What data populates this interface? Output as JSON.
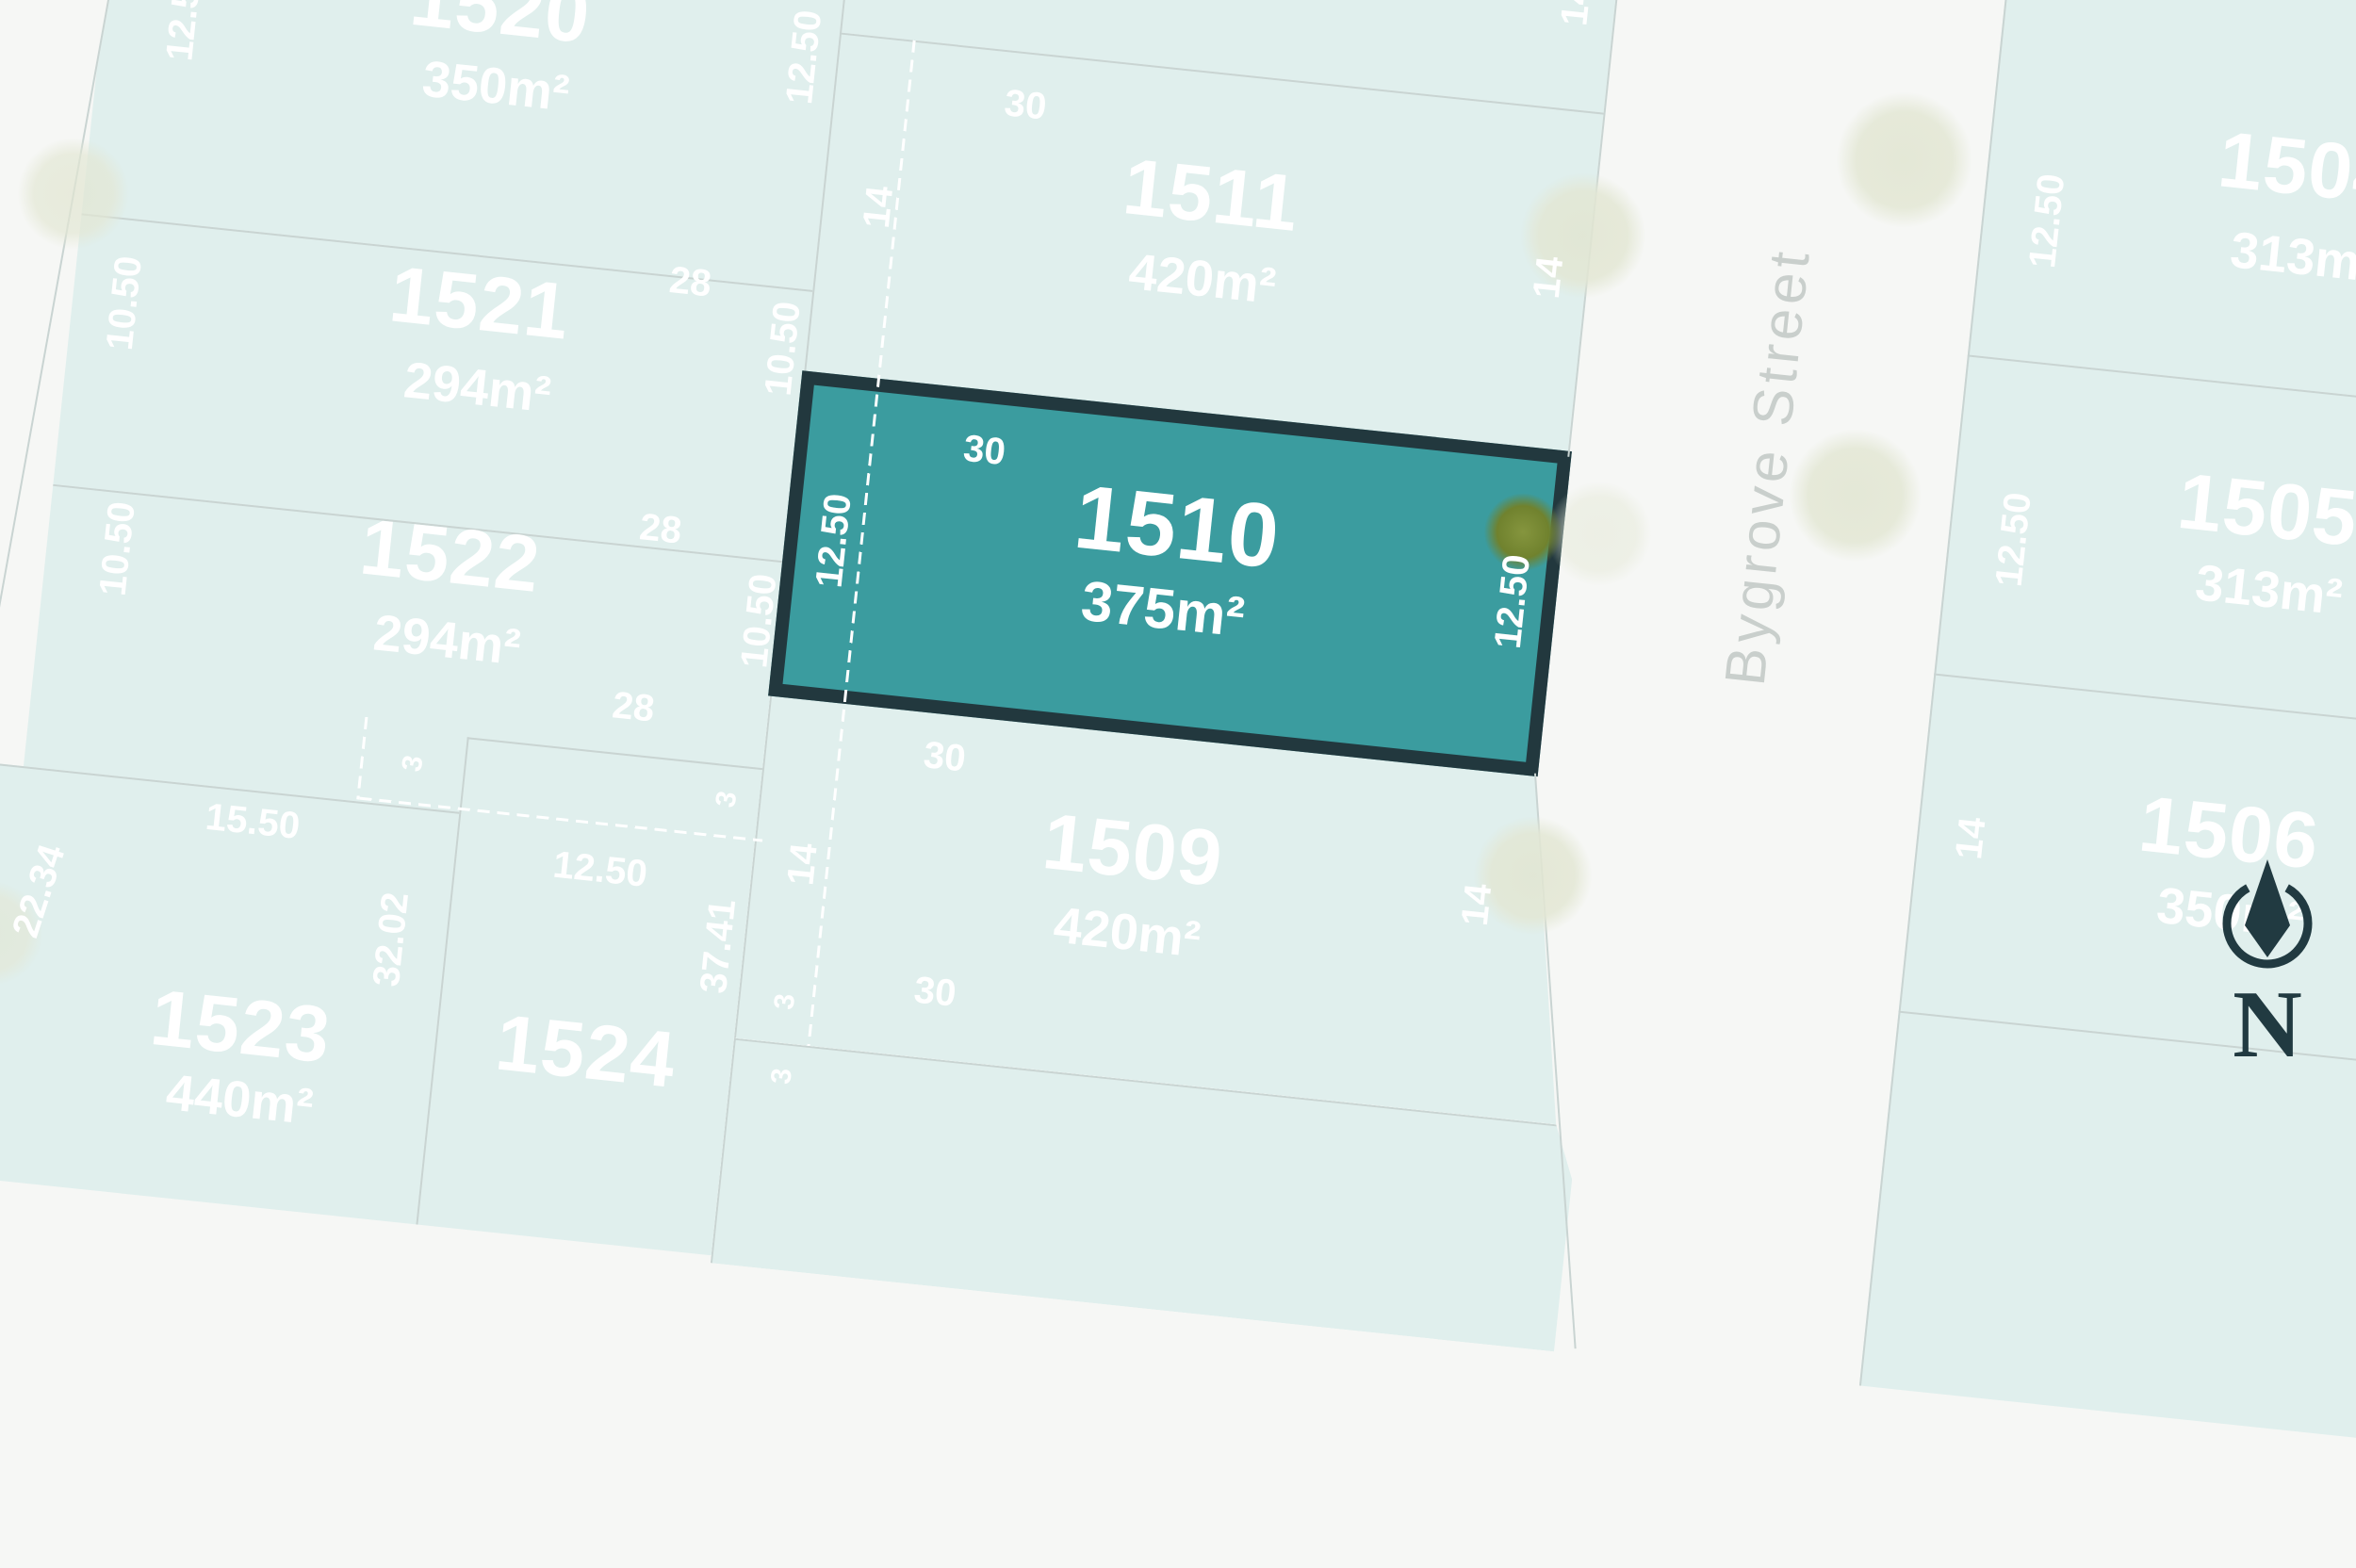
{
  "map": {
    "street": {
      "name": "Bygrove Street"
    },
    "compass": {
      "label": "N"
    },
    "lots": {
      "l1504": {
        "number": "1504",
        "area": "313m²"
      },
      "l1505": {
        "number": "1505",
        "area": "313m²"
      },
      "l1506": {
        "number": "1506",
        "area": "350m²"
      },
      "l1509": {
        "number": "1509",
        "area": "420m²"
      },
      "l1510": {
        "number": "1510",
        "area": "375m²",
        "highlighted": true
      },
      "l1511": {
        "number": "1511",
        "area": "420m²"
      },
      "l1520": {
        "number": "1520",
        "area": "350m²"
      },
      "l1521": {
        "number": "1521",
        "area": "294m²"
      },
      "l1522": {
        "number": "1522",
        "area": "294m²"
      },
      "l1523": {
        "number": "1523",
        "area": "440m²"
      },
      "l1524": {
        "number": "1524"
      }
    },
    "dimensions": {
      "lot1520_left": "12.50",
      "lot1520_right": "12.50",
      "lot1521_left": "10.50",
      "lot1521_right": "10.50",
      "lot1522_left": "10.50",
      "lot1522_right": "10.50",
      "len28_a": "28",
      "len28_b": "28",
      "len28_c": "28",
      "lot1511_top": "30",
      "lot1511_left": "14",
      "lot1511_right": "14",
      "lot_top_right": "14",
      "lot1510_top": "30",
      "lot1510_left": "12.50",
      "lot1510_right": "12.50",
      "lot1509_top": "30",
      "lot1509_bottom": "30",
      "lot1509_left": "14",
      "lot1509_right": "14",
      "lot1523_top": "15.50",
      "lot1523_left": "22.34",
      "lot1523_right": "32.02",
      "lot1524_top": "12.50",
      "lot1524_right": "37.41",
      "setback3_a": "3",
      "setback3_b": "3",
      "setback3_c": "3",
      "setback3_d": "3",
      "lot1504_left": "12.50",
      "lot1505_left": "12.50",
      "lot1506_left": "14"
    },
    "colors": {
      "highlight_fill": "#3b9c9f",
      "highlight_border": "#22383e",
      "lot_fill": "#e0efed",
      "boundary_line": "#c9d4d2",
      "background": "#f6f7f5",
      "dimension_text": "#ffffff",
      "street_text": "#c9cfcc",
      "compass": "#213a41",
      "tree": "#e3e7d4",
      "tree_highlight": "#70822e"
    }
  }
}
